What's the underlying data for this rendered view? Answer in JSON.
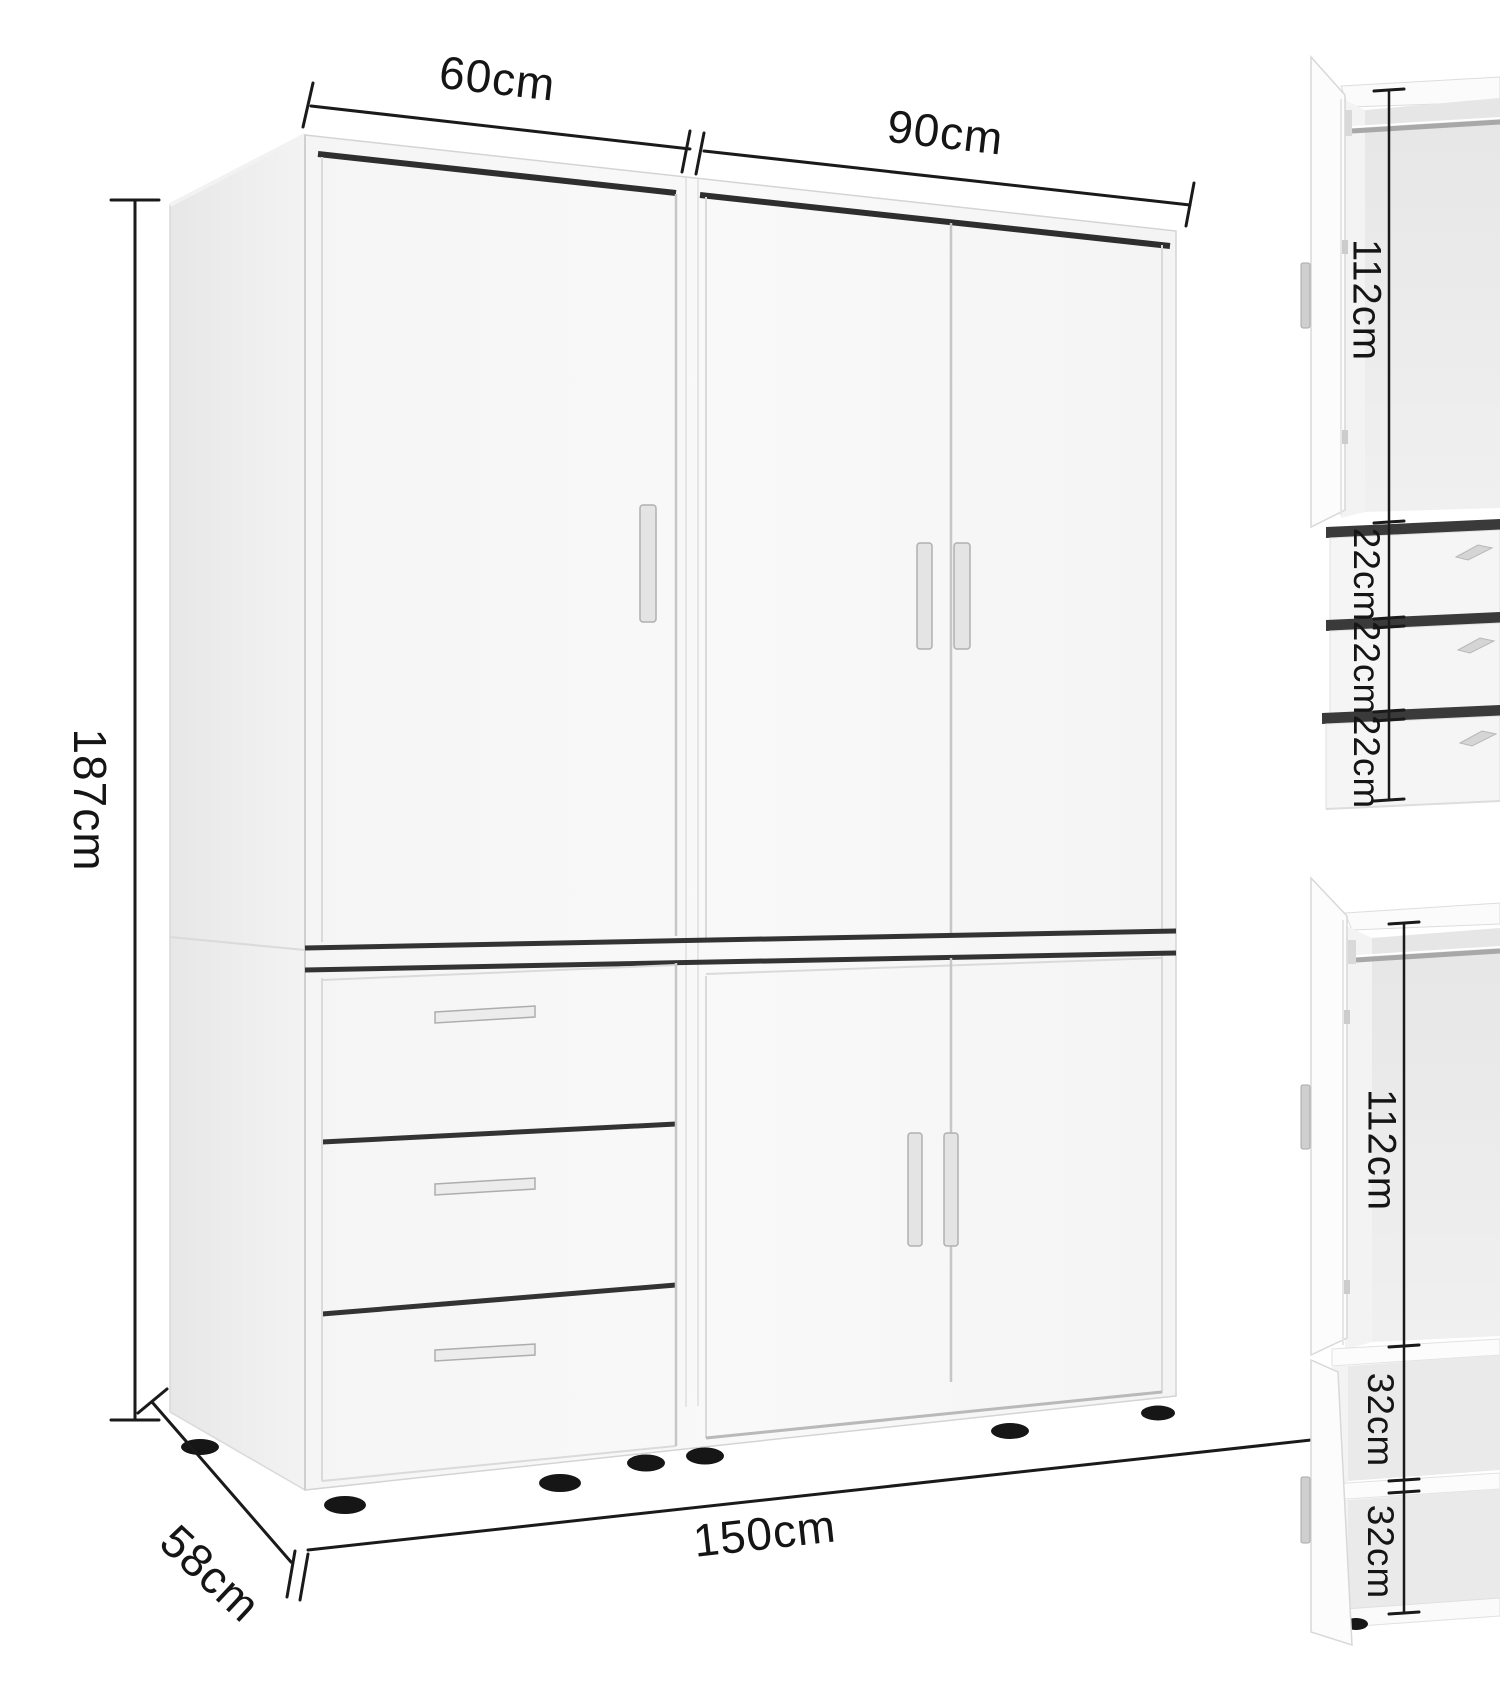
{
  "diagram_title": "wardrobe-dimension-diagram",
  "colors": {
    "background": "#ffffff",
    "dimension_line": "#1a1a1a",
    "label_text": "#151515",
    "cabinet_front": "#f8f8f8",
    "cabinet_side": "#ededed",
    "interior_back": "#eaeaea",
    "gap_dark": "#2e2e2e",
    "handle": "#e4e4e4",
    "foot": "#161616"
  },
  "labels": {
    "top_width_left": "60cm",
    "top_width_right": "90cm",
    "height": "187cm",
    "depth": "58cm",
    "total_width": "150cm"
  },
  "detail_top": {
    "interior_height": "112cm",
    "drawers": [
      "22cm",
      "22cm",
      "22cm"
    ]
  },
  "detail_bottom": {
    "interior_height": "112cm",
    "compartments": [
      "32cm",
      "32cm"
    ]
  }
}
